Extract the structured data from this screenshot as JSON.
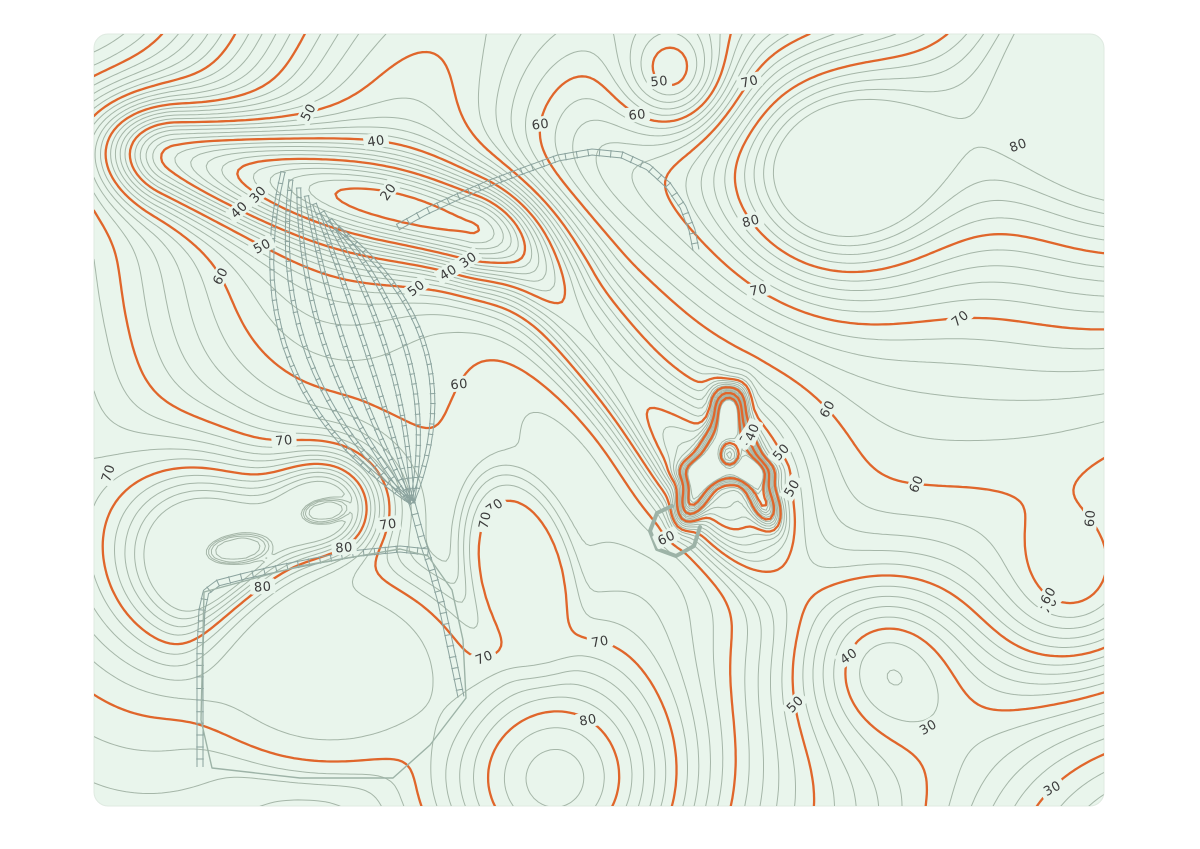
{
  "title": "Topographic contour map with railway yard",
  "page": {
    "background": "#ffffff"
  },
  "card": {
    "x": 94,
    "y": 34,
    "width": 1010,
    "height": 772,
    "radius": 14,
    "background": "#e9f5ec",
    "border": "#dfeae1"
  },
  "colors": {
    "contour_minor": "#a5b6a8",
    "contour_major": "#e0662b",
    "label_text": "#3b3b3b",
    "railway": "#8ba39e",
    "outline": "#9db3a7"
  },
  "contours": {
    "minor_interval": 2,
    "major_interval": 10,
    "min_level": 16,
    "max_level": 88,
    "minor_width": 1,
    "major_width": 2.3
  },
  "terrain": {
    "base": 52,
    "gaussians": [
      [
        60,
        -70,
        40,
        170
      ],
      [
        -40,
        360,
        22,
        160
      ],
      [
        150,
        680,
        16,
        200
      ],
      [
        215,
        555,
        29,
        70
      ],
      [
        330,
        505,
        26,
        40
      ],
      [
        560,
        785,
        30,
        105
      ],
      [
        830,
        170,
        33,
        90
      ],
      [
        1150,
        60,
        46,
        160
      ],
      [
        430,
        160,
        -11,
        130
      ],
      [
        585,
        155,
        16,
        95
      ],
      [
        675,
        80,
        -16,
        40
      ],
      [
        950,
        430,
        10,
        260
      ],
      [
        1080,
        600,
        12,
        60
      ],
      [
        1160,
        870,
        -33,
        190
      ],
      [
        880,
        660,
        -16,
        65
      ],
      [
        729,
        465,
        -12,
        60
      ]
    ],
    "ridges": [
      [
        170,
        155,
        470,
        228,
        -30,
        38,
        55,
        0
      ],
      [
        540,
        310,
        700,
        525,
        -20,
        50,
        60,
        1
      ],
      [
        475,
        295,
        695,
        510,
        8,
        120,
        80,
        -1
      ],
      [
        692,
        500,
        729,
        412,
        -24,
        9,
        18,
        0
      ],
      [
        729,
        412,
        764,
        502,
        -24,
        9,
        18,
        0
      ],
      [
        701,
        472,
        752,
        472,
        -20,
        8,
        14,
        0
      ]
    ],
    "flats": [
      [
        335,
        668,
        140,
        108,
        -6,
        72.6
      ],
      [
        520,
        570,
        56,
        102,
        -14,
        71.0
      ],
      [
        237,
        549,
        34,
        16,
        -8,
        80.9
      ],
      [
        325,
        511,
        25,
        13,
        -10,
        80.9
      ]
    ]
  },
  "labels": [
    {
      "v": 50,
      "x": 297,
      "y": 57,
      "r": -62
    },
    {
      "v": 40,
      "x": 374,
      "y": 150,
      "r": -8
    },
    {
      "v": 30,
      "x": 263,
      "y": 187,
      "r": -48
    },
    {
      "v": 40,
      "x": 238,
      "y": 208,
      "r": -45
    },
    {
      "v": 50,
      "x": 252,
      "y": 264,
      "r": -28
    },
    {
      "v": 60,
      "x": 166,
      "y": 308,
      "r": -62
    },
    {
      "v": 20,
      "x": 388,
      "y": 196,
      "r": -55
    },
    {
      "v": 30,
      "x": 465,
      "y": 267,
      "r": -35
    },
    {
      "v": 40,
      "x": 443,
      "y": 288,
      "r": -32
    },
    {
      "v": 50,
      "x": 415,
      "y": 313,
      "r": -38
    },
    {
      "v": 60,
      "x": 452,
      "y": 378,
      "r": -6
    },
    {
      "v": 50,
      "x": 667,
      "y": 73,
      "r": -5
    },
    {
      "v": 60,
      "x": 559,
      "y": 128,
      "r": -8
    },
    {
      "v": 60,
      "x": 629,
      "y": 131,
      "r": -6
    },
    {
      "v": 70,
      "x": 800,
      "y": 116,
      "r": -14
    },
    {
      "v": 80,
      "x": 1018,
      "y": 145,
      "r": -20
    },
    {
      "v": 80,
      "x": 806,
      "y": 182,
      "r": -15
    },
    {
      "v": 70,
      "x": 753,
      "y": 300,
      "r": -10
    },
    {
      "v": 70,
      "x": 962,
      "y": 365,
      "r": -38
    },
    {
      "v": 60,
      "x": 860,
      "y": 380,
      "r": -62
    },
    {
      "v": 60,
      "x": 910,
      "y": 522,
      "r": -68
    },
    {
      "v": 60,
      "x": 1090,
      "y": 517,
      "r": -85
    },
    {
      "v": 70,
      "x": 285,
      "y": 427,
      "r": -5
    },
    {
      "v": 70,
      "x": 108,
      "y": 473,
      "r": -72
    },
    {
      "v": 70,
      "x": 461,
      "y": 464,
      "r": -35
    },
    {
      "v": 30,
      "x": 727,
      "y": 446,
      "r": -55
    },
    {
      "v": 40,
      "x": 752,
      "y": 431,
      "r": -68
    },
    {
      "v": 50,
      "x": 828,
      "y": 424,
      "r": -48
    },
    {
      "v": 50,
      "x": 771,
      "y": 492,
      "r": -60
    },
    {
      "v": 80,
      "x": 322,
      "y": 511,
      "r": -4
    },
    {
      "v": 80,
      "x": 236,
      "y": 549,
      "r": -4
    },
    {
      "v": 70,
      "x": 397,
      "y": 527,
      "r": -8
    },
    {
      "v": 70,
      "x": 497,
      "y": 524,
      "r": -78
    },
    {
      "v": 60,
      "x": 633,
      "y": 567,
      "r": -25
    },
    {
      "v": 70,
      "x": 599,
      "y": 647,
      "r": -10
    },
    {
      "v": 70,
      "x": 486,
      "y": 689,
      "r": -22
    },
    {
      "v": 80,
      "x": 576,
      "y": 742,
      "r": -10
    },
    {
      "v": 40,
      "x": 796,
      "y": 638,
      "r": -35
    },
    {
      "v": 50,
      "x": 811,
      "y": 700,
      "r": -45
    },
    {
      "v": 30,
      "x": 928,
      "y": 727,
      "r": -30
    },
    {
      "v": 70,
      "x": 1049,
      "y": 605,
      "r": -50
    },
    {
      "v": 60,
      "x": 1013,
      "y": 647,
      "r": -60
    },
    {
      "v": 30,
      "x": 1053,
      "y": 788,
      "r": -28
    }
  ],
  "railways": {
    "tie_spacing": 9,
    "fan": {
      "starts_from": [
        283,
        172
      ],
      "starts_to": [
        338,
        228
      ],
      "apex": [
        412,
        503
      ],
      "count": 8,
      "gauge": 4,
      "bulges": [
        124,
        91,
        58,
        25,
        -8,
        -41,
        -74,
        -106
      ]
    },
    "lines": [
      {
        "name": "ne-track",
        "gauge": 6,
        "pts": [
          [
            398,
            227
          ],
          [
            425,
            212
          ],
          [
            455,
            198
          ],
          [
            490,
            183
          ],
          [
            525,
            170
          ],
          [
            558,
            158
          ],
          [
            592,
            152
          ],
          [
            622,
            155
          ],
          [
            648,
            167
          ],
          [
            668,
            185
          ],
          [
            683,
            207
          ],
          [
            692,
            230
          ],
          [
            696,
            250
          ]
        ]
      },
      {
        "name": "south-track",
        "gauge": 6,
        "pts": [
          [
            412,
            503
          ],
          [
            422,
            540
          ],
          [
            432,
            570
          ],
          [
            441,
            602
          ],
          [
            448,
            635
          ],
          [
            455,
            668
          ],
          [
            461,
            697
          ]
        ]
      },
      {
        "name": "west-branch",
        "gauge": 6,
        "pts": [
          [
            428,
            552
          ],
          [
            400,
            549
          ],
          [
            360,
            553
          ],
          [
            320,
            560
          ],
          [
            280,
            568
          ],
          [
            245,
            576
          ],
          [
            218,
            583
          ],
          [
            206,
            592
          ],
          [
            202,
            610
          ],
          [
            200,
            650
          ],
          [
            200,
            700
          ],
          [
            200,
            735
          ],
          [
            200,
            767
          ]
        ]
      }
    ],
    "outlines": [
      {
        "name": "pad-outline",
        "width": 1.4,
        "pts": [
          [
            204,
            592
          ],
          [
            300,
            566
          ],
          [
            400,
            549
          ],
          [
            428,
            556
          ],
          [
            452,
            590
          ],
          [
            463,
            640
          ],
          [
            466,
            698
          ],
          [
            430,
            745
          ],
          [
            393,
            778
          ],
          [
            300,
            778
          ],
          [
            212,
            768
          ],
          [
            201,
            720
          ],
          [
            204,
            592
          ]
        ]
      },
      {
        "name": "pit-ramp-hook",
        "width": 4,
        "pts": [
          [
            700,
            527
          ],
          [
            694,
            546
          ],
          [
            676,
            556
          ],
          [
            657,
            549
          ],
          [
            650,
            531
          ],
          [
            657,
            513
          ],
          [
            672,
            506
          ]
        ]
      }
    ]
  }
}
